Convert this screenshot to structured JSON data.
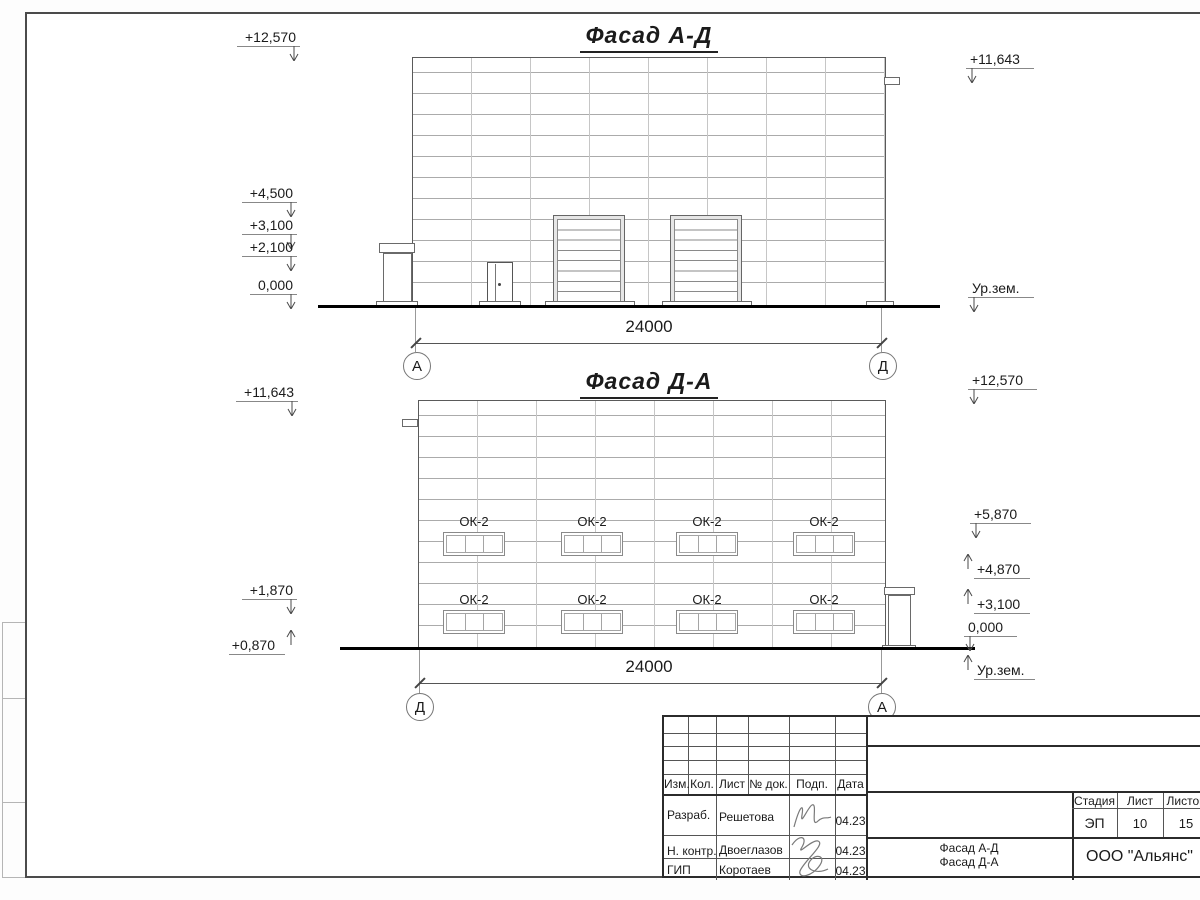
{
  "facade_top": {
    "title": "Фасад А-Д",
    "dimension": "24000",
    "axis_left": "А",
    "axis_right": "Д",
    "marks": [
      {
        "label": "+12,570",
        "cls": "down-right",
        "right": 900,
        "top": 30
      },
      {
        "label": "+4,500",
        "cls": "down-right",
        "right": 903,
        "top": 186
      },
      {
        "label": "+3,100",
        "cls": "down-right",
        "right": 903,
        "top": 218
      },
      {
        "label": "+2,100",
        "cls": "down-right",
        "right": 903,
        "top": 240
      },
      {
        "label": "0,000",
        "cls": "down-right",
        "right": 903,
        "top": 278
      },
      {
        "label": "+11,643",
        "cls": "down-left",
        "left": 966,
        "top": 52
      },
      {
        "label": "Ур.зем.",
        "cls": "down-left",
        "left": 968,
        "top": 281
      }
    ]
  },
  "facade_bottom": {
    "title": "Фасад Д-А",
    "dimension": "24000",
    "axis_left": "Д",
    "axis_right": "А",
    "window_label": "ОК-2",
    "marks": [
      {
        "label": "+11,643",
        "cls": "down-right",
        "right": 902,
        "top": 385
      },
      {
        "label": "+1,870",
        "cls": "down-right",
        "right": 903,
        "top": 583
      },
      {
        "label": "+0,870",
        "cls": "up-right",
        "right": 903,
        "top": 638
      },
      {
        "label": "+12,570",
        "cls": "down-left",
        "left": 968,
        "top": 373
      },
      {
        "label": "+5,870",
        "cls": "down-left",
        "left": 970,
        "top": 507
      },
      {
        "label": "+4,870",
        "cls": "up-left",
        "left": 962,
        "top": 562
      },
      {
        "label": "+3,100",
        "cls": "up-left",
        "left": 962,
        "top": 597
      },
      {
        "label": "0,000",
        "cls": "down-left",
        "left": 964,
        "top": 620
      },
      {
        "label": "Ур.зем.",
        "cls": "up-left",
        "left": 962,
        "top": 663
      }
    ]
  },
  "title_block": {
    "columns": [
      "Изм.",
      "Кол.",
      "Лист",
      "№ док.",
      "Подп.",
      "Дата"
    ],
    "rows": [
      {
        "role": "Разраб.",
        "name": "Решетова",
        "date": "04.23"
      },
      {
        "role": "Н. контр.",
        "name": "Двоеглазов",
        "date": "04.23"
      },
      {
        "role": "ГИП",
        "name": "Коротаев",
        "date": "04.23"
      }
    ],
    "stage_label": "Стадия",
    "sheet_label": "Лист",
    "sheets_label": "Листов",
    "stage": "ЭП",
    "sheet": "10",
    "sheets": "15",
    "doc_name_line1": "Фасад А-Д",
    "doc_name_line2": "Фасад Д-А",
    "company": "ООО \"Альянс\""
  }
}
